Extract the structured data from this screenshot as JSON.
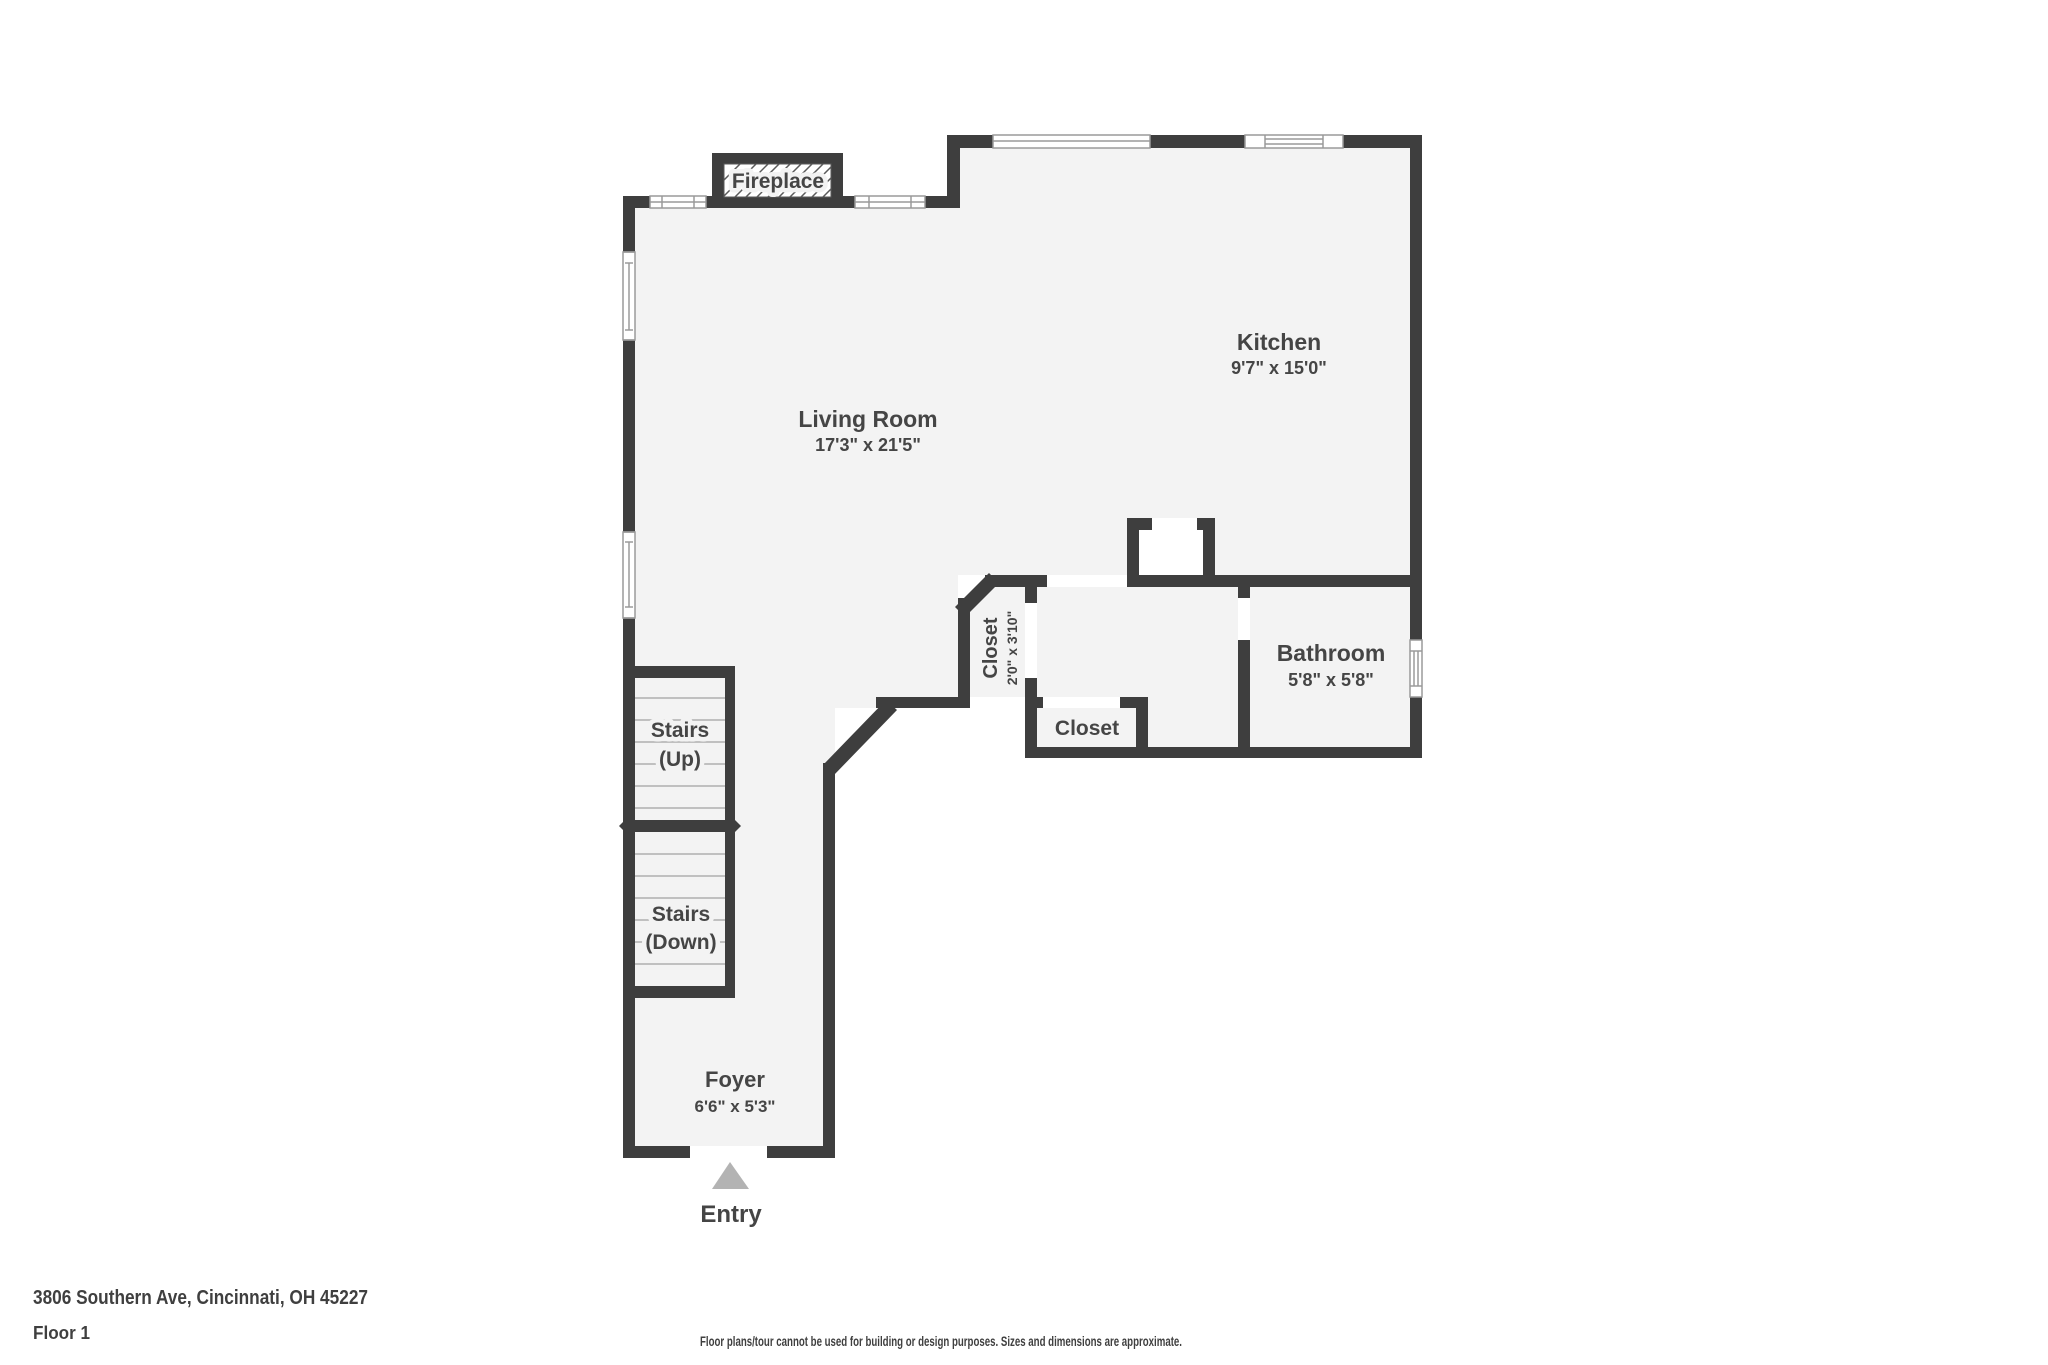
{
  "address": "3806 Southern Ave, Cincinnati, OH 45227",
  "floor_label": "Floor 1",
  "disclaimer": "Floor plans/tour cannot be used for building or design purposes. Sizes and dimensions are approximate.",
  "fireplace_label": "Fireplace",
  "entry_label": "Entry",
  "rooms": {
    "living_room": {
      "name": "Living Room",
      "dims": "17'3\" x 21'5\""
    },
    "kitchen": {
      "name": "Kitchen",
      "dims": "9'7\" x 15'0\""
    },
    "bathroom": {
      "name": "Bathroom",
      "dims": "5'8\" x 5'8\""
    },
    "closet_hall": {
      "name": "Closet",
      "dims": "2'0\" x 3'10\""
    },
    "closet_small": {
      "name": "Closet"
    },
    "foyer": {
      "name": "Foyer",
      "dims": "6'6\" x 5'3\""
    },
    "stairs_up": {
      "line1": "Stairs",
      "line2": "(Up)"
    },
    "stairs_down": {
      "line1": "Stairs",
      "line2": "(Down)"
    }
  },
  "colors": {
    "wall": "#3e3e3e",
    "floor": "#f3f3f3",
    "text": "#454545",
    "tread_line": "#c0c0c0",
    "window_line": "#9a9a9a",
    "entry_arrow": "#b3b3b3",
    "hatch_line": "#5a5a5a"
  }
}
